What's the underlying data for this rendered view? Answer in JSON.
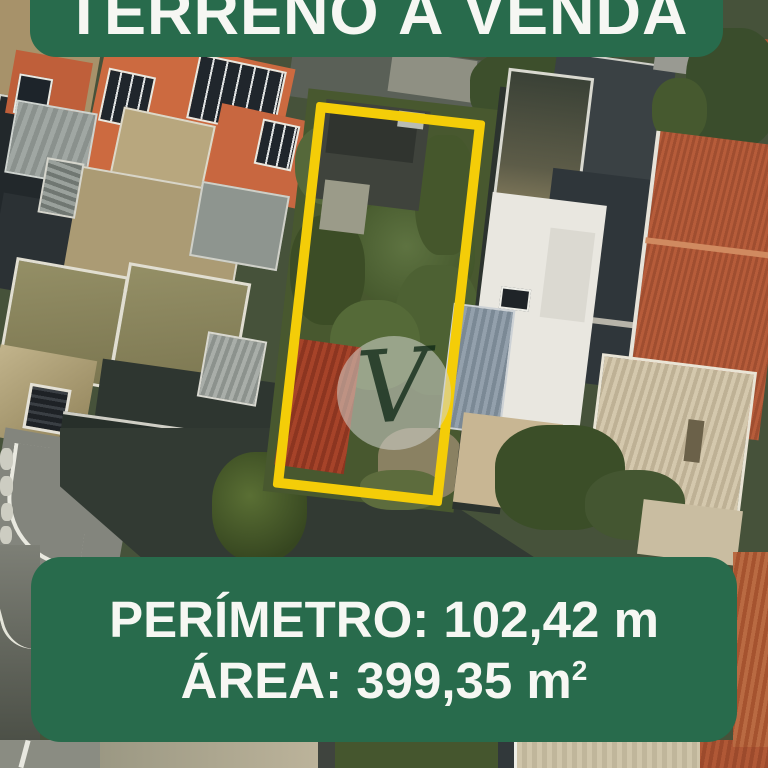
{
  "top_banner": {
    "title": "TERRENO À VENDA"
  },
  "bottom_banner": {
    "perimeter": "PERÍMETRO: 102,42 m",
    "area": "ÁREA: 399,35 m",
    "area_sup": "2"
  },
  "watermark": {
    "letter": "V"
  },
  "colors": {
    "banner_green": "#286b4c",
    "boundary_yellow": "#f4cd08",
    "text_white": "#f6f7f3"
  }
}
